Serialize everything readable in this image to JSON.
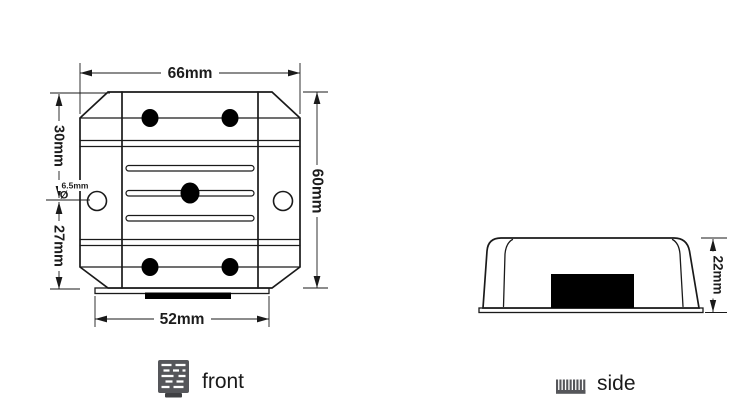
{
  "diagram": {
    "title": "product-dimension-drawing",
    "front_view": {
      "label": "front",
      "dim_width": "66mm",
      "dim_height": "60mm",
      "dim_upper": "30mm",
      "dim_lower": "27mm",
      "dim_hole_symbol": "Ø",
      "dim_hole": "6.5mm",
      "dim_bottom_width": "52mm"
    },
    "side_view": {
      "label": "side",
      "dim_height": "22mm"
    },
    "colors": {
      "line": "#1a1a1a",
      "fill_black": "#000000",
      "icon_gray": "#55565a",
      "icon_gray_dark": "#3f4043",
      "background": "#ffffff"
    }
  }
}
